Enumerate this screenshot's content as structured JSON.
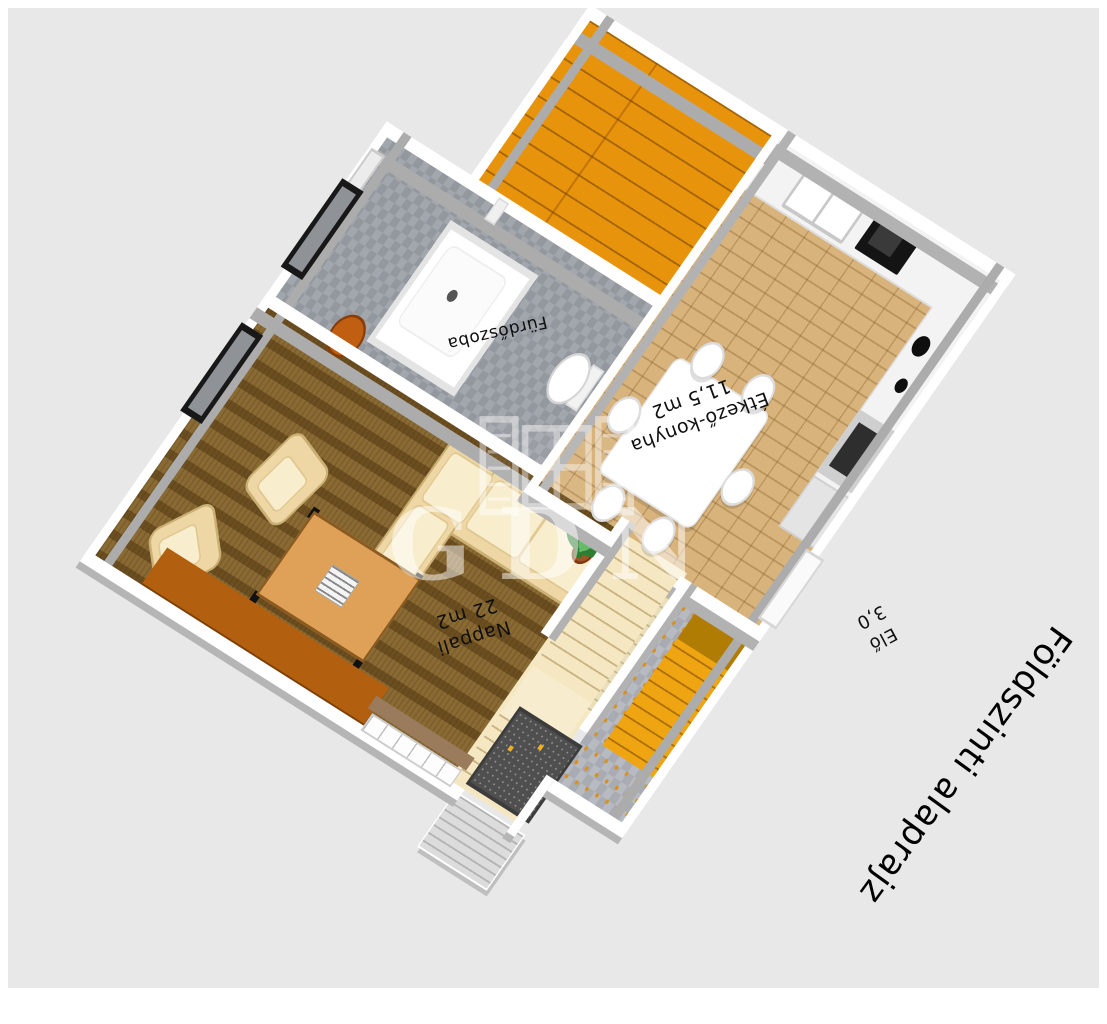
{
  "title": "Földszinti alaprajz",
  "watermark": {
    "text": "GDN",
    "icon": "gdn-open-window-icon"
  },
  "rooms": {
    "nappali": {
      "name": "Nappali",
      "area": "22 m2"
    },
    "etkezo_konyha": {
      "name": "Étkező-konyha",
      "area": "11,5 m2"
    },
    "furdoszoba": {
      "name": "Fürdőszoba"
    },
    "eloszoba": {
      "name": "Elő",
      "area": "3,0"
    }
  },
  "colors": {
    "background": "#E8E8E8",
    "carpet_brown": "#8A6A33",
    "parquet": "#D8B37C",
    "stairs_orange": "#E8930C",
    "hall_stairs_orange": "#EFA512",
    "tile_grey": "#A8ABB2",
    "sofa_cream": "#EED7A4",
    "sideboard_orange": "#B26010",
    "wall_white": "#FFFFFF",
    "wall_face_grey": "#ACACAC",
    "label_text": "#101010"
  }
}
